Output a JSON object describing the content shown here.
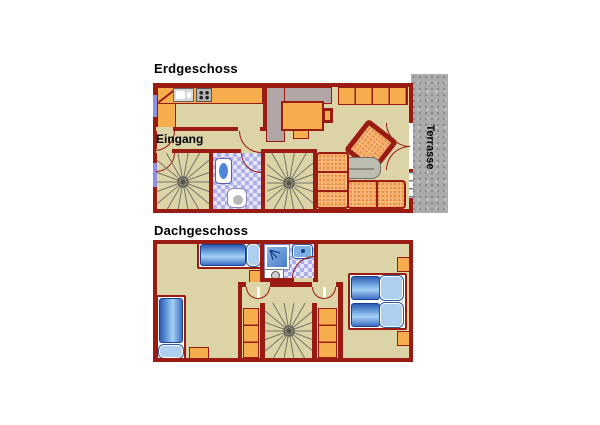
{
  "colors": {
    "wall": "#9a1b12",
    "floor_tan": "#dcd3a6",
    "furniture_orange": "#f6ad4e",
    "sofa_orange": "#f9c08a",
    "bed_blue": "#4a7cc8",
    "bathroom_tile": "#aeaeea",
    "terrace_gray": "#ababab",
    "stair_line_gray": "#76766a"
  },
  "floors": [
    {
      "id": "erdgeschoss",
      "title": "Erdgeschoss",
      "labels": {
        "entrance": "Eingang",
        "terrace": "Terrasse"
      },
      "rooms": [
        "kitchen",
        "entrance-hall",
        "spiral-staircase-left",
        "bathroom",
        "spiral-staircase-right",
        "living-room",
        "terrace"
      ],
      "furniture": [
        "kitchen-counter",
        "kitchen-sink",
        "stove",
        "desk-platform",
        "desk",
        "desk-chair",
        "cabinet-row",
        "armchair",
        "coffee-table",
        "corner-sofa",
        "wash-basin",
        "toilet"
      ]
    },
    {
      "id": "dachgeschoss",
      "title": "Dachgeschoss",
      "rooms": [
        "bedroom-left",
        "bathroom",
        "stair-hall",
        "bedroom-right"
      ],
      "furniture": [
        "single-bed-horizontal",
        "single-bed-vertical",
        "double-bed-pair",
        "shower",
        "washer",
        "wash-basin",
        "wardrobe-left",
        "wardrobe-right",
        "nightstands"
      ]
    }
  ]
}
